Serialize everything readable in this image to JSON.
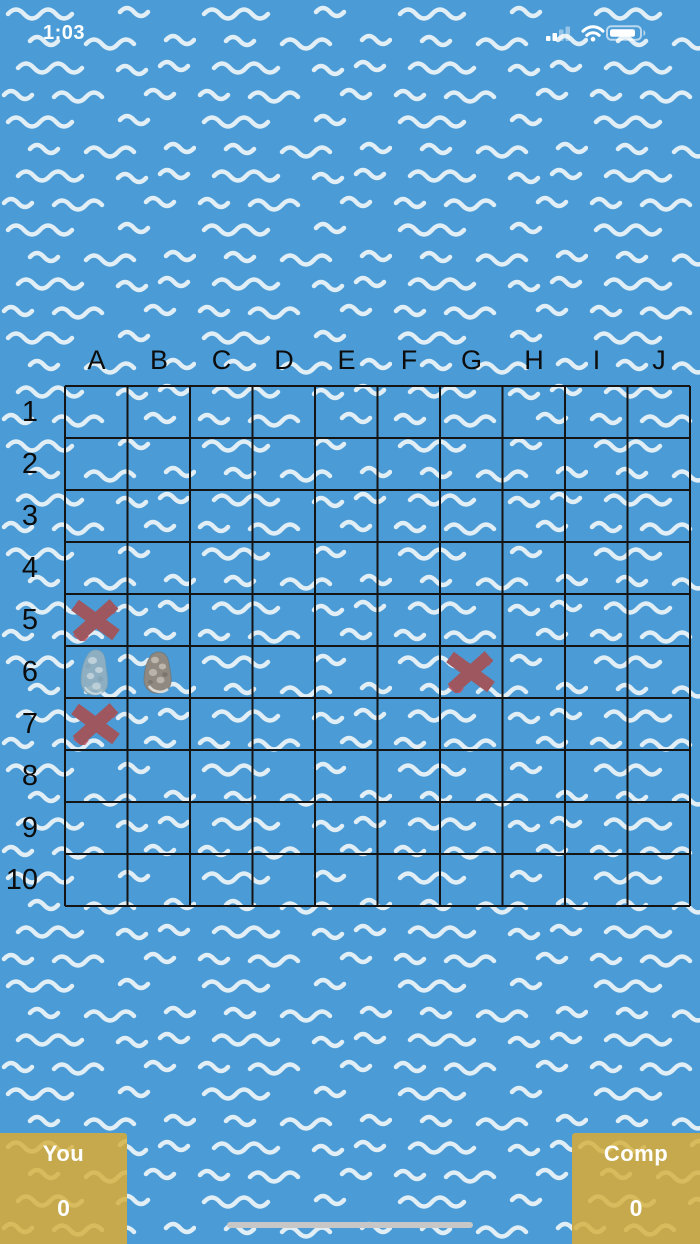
{
  "status_bar": {
    "time": "1:03",
    "cellular_icon": "cellular-signal-2-of-4-bars",
    "wifi_icon": "wifi-full",
    "battery_icon": "battery-high"
  },
  "board": {
    "column_labels": [
      "A",
      "B",
      "C",
      "D",
      "E",
      "F",
      "G",
      "H",
      "I",
      "J"
    ],
    "row_labels": [
      "1",
      "2",
      "3",
      "4",
      "5",
      "6",
      "7",
      "8",
      "9",
      "10"
    ],
    "markers": [
      {
        "cell": "A5",
        "type": "miss-x",
        "label": "miss"
      },
      {
        "cell": "A6",
        "type": "rock-blue",
        "label": "rock"
      },
      {
        "cell": "B6",
        "type": "rock-gray",
        "label": "rock"
      },
      {
        "cell": "A7",
        "type": "miss-x",
        "label": "miss"
      },
      {
        "cell": "G6",
        "type": "miss-x",
        "label": "miss"
      }
    ]
  },
  "scoreboard": {
    "player": {
      "label": "You",
      "score": "0"
    },
    "opponent": {
      "label": "Comp",
      "score": "0"
    }
  },
  "colors": {
    "water": "#4B9CD6",
    "wave": "#EDF5F8",
    "grid_line": "#141414",
    "label_text": "#0C0C0C",
    "miss_x": "#9E565F",
    "miss_x_accent": "#C05763",
    "rock_blue": "#96B1C0",
    "rock_gray": "#8F8982",
    "panel_gold": "#C5A94C",
    "panel_wave": "#D8BC5E",
    "panel_text": "#FFFFFF",
    "home_indicator": "#C7C7C7"
  }
}
